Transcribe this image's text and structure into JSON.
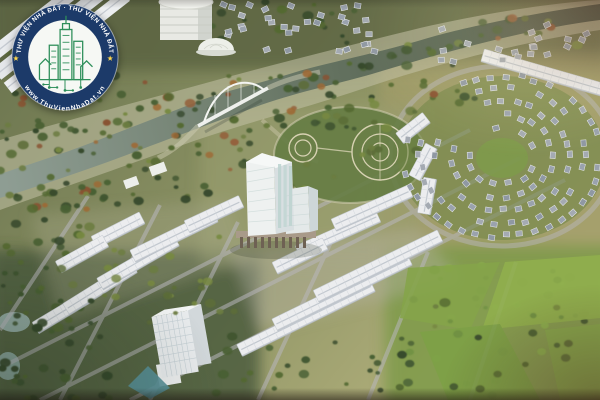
{
  "meta": {
    "title": "Aerial 3D render of a mixed-use urban master plan with river, bridge, high-rise tower, townhouse rows and villa district",
    "kind": "photographic-render",
    "width": 600,
    "height": 400
  },
  "watermark": {
    "arc_top": "THƯ VIỆN NHÀ ĐẤT · THƯ VIỆN NHÀ ĐẤT",
    "arc_bottom": "www.ThuVienNhaDat.vn",
    "separator": "★",
    "colors": {
      "ring": "#1c3a69",
      "ring_edge": "#ffffff",
      "inner": "#f6f8f4",
      "emblem": "#2e8f5a",
      "text": "#ffffff",
      "star": "#ffd84d"
    }
  },
  "scene": {
    "landmarks": [
      "river with arch bridge",
      "cylindrical tower and domed hall",
      "central glass high-rise tower",
      "white townhouse rows",
      "curved villa subdivision",
      "circular formal park",
      "office mid-rise",
      "green lawns"
    ],
    "palette": {
      "river_dark": "#43503f",
      "river_light": "#8e9d93",
      "bank": "#c3c1a6",
      "road": "#b9b6bd",
      "row_fill": "#ecedef",
      "row_ridge": "#c2c8cf",
      "row_tick": "#d4d8dd",
      "villa_roofs": [
        "#9aa2ad",
        "#a4aab2",
        "#8f98a4"
      ],
      "villa_edge": "#e9ebee",
      "tree_dark": [
        "#36492b",
        "#3f5530",
        "#486032",
        "#53692f"
      ],
      "tree_olive": [
        "#5c6d36",
        "#6b7c3e",
        "#77893f"
      ],
      "tree_bright": [
        "#6f9240",
        "#7ea647",
        "#8ab04b"
      ],
      "tree_orange": [
        "#96613a",
        "#8a5230",
        "#a06a33"
      ],
      "lawn": [
        "#84a647",
        "#8fb14b",
        "#7da244",
        "#86a94a"
      ],
      "tower_front": "#eef1f0",
      "tower_side": "#d8dfe1",
      "tower_glass": "#bcd4d0",
      "park_ring": "#d8d2b2"
    }
  }
}
